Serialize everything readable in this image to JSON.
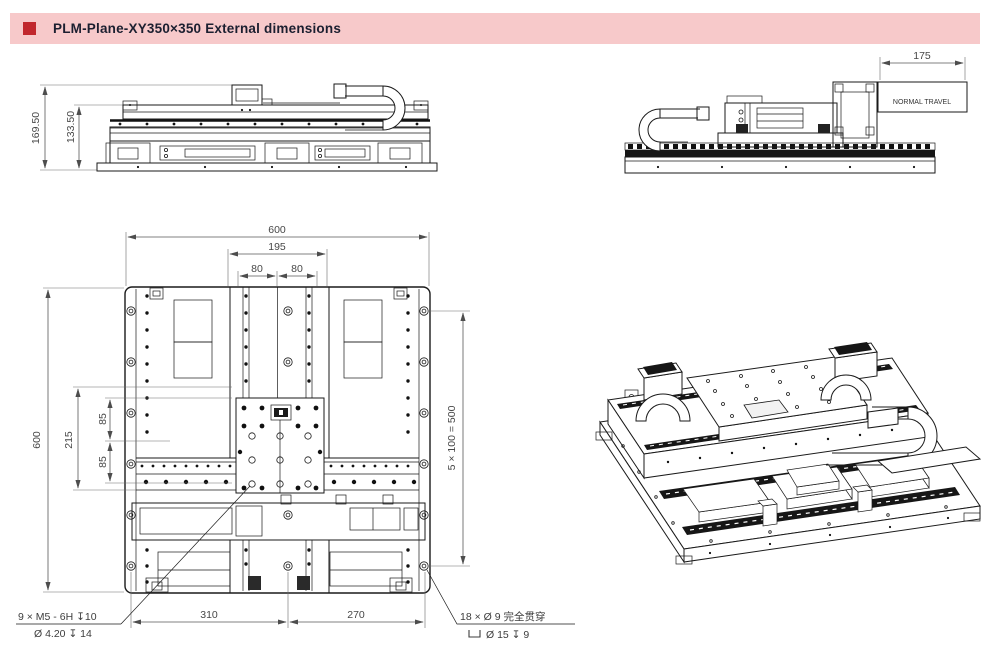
{
  "header": {
    "title": "PLM-Plane-XY350×350 External dimensions",
    "accent_color": "#c1272d",
    "bar_color": "#f7c9ca"
  },
  "side_view_left": {
    "dim_total_height": "169.50",
    "dim_table_height": "133.50"
  },
  "side_view_right": {
    "dim_travel": "175",
    "travel_box_label": "NORMAL TRAVEL"
  },
  "plan_view": {
    "dim_width_overall": "600",
    "dim_platform_width": "195",
    "dim_pitch_left": "80",
    "dim_pitch_right": "80",
    "dim_height_overall": "600",
    "dim_carriage": "215",
    "dim_pitch_upper": "85",
    "dim_pitch_lower": "85",
    "dim_mount_holes": "5 × 100 = 500",
    "dim_bottom_left": "310",
    "dim_bottom_right": "270"
  },
  "notes": {
    "tapped_line1": "9 × M5 - 6H ↧10",
    "tapped_line2": "Ø 4.20 ↧ 14",
    "through_line1": "18 × Ø 9 完全贯穿",
    "through_symbol": "⌴",
    "through_line2": "Ø 15 ↧ 9"
  }
}
